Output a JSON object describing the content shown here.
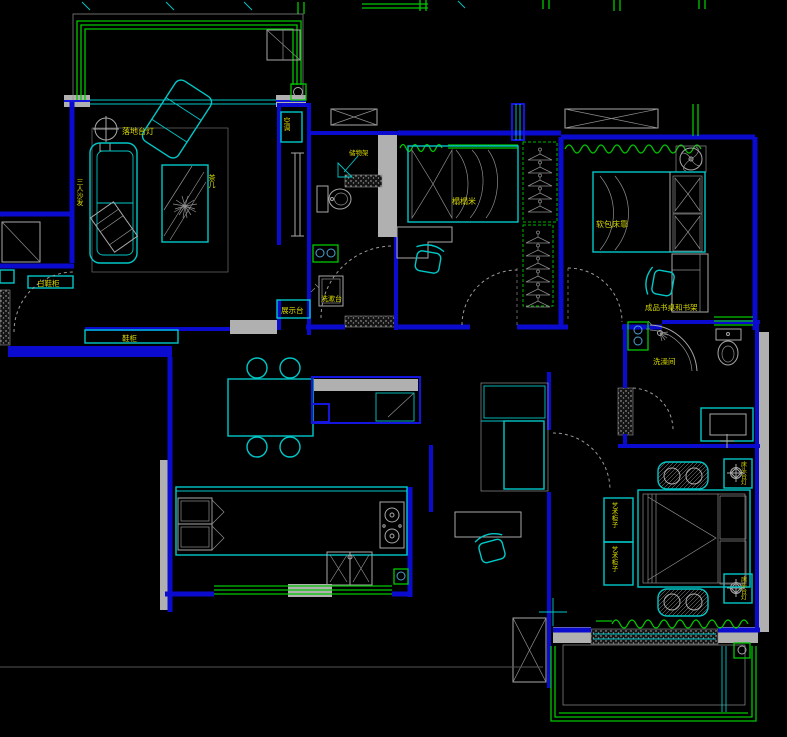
{
  "drawing": {
    "type": "apartment floor plan (CAD)",
    "colors": {
      "background": "#000000",
      "wall": "#0b0bd0",
      "furniture": "#00c8c8",
      "window": "#00c800",
      "detail_gray": "#a8a8a8",
      "label": "#d8d800"
    }
  },
  "labels": {
    "floor_lamp": {
      "text": "落地台灯"
    },
    "sofa": {
      "text": "三人沙发"
    },
    "coffee_table": {
      "text": "茶几"
    },
    "ac_unit": {
      "text": "空调"
    },
    "storage_rack": {
      "text": "储物架"
    },
    "tatami": {
      "text": "榻榻米"
    },
    "bed_headboard": {
      "text": "软包床靠"
    },
    "desk_bookshelf": {
      "text": "成品书桌和书架"
    },
    "shoe_cabinet_small": {
      "text": "白鞋柜"
    },
    "shoe_cabinet": {
      "text": "鞋柜"
    },
    "display_stand": {
      "text": "展示台"
    },
    "wash_counter": {
      "text": "洗漱台"
    },
    "shower_room": {
      "text": "洗澡间"
    },
    "art_cabinet_1": {
      "text": "艺术柜子"
    },
    "art_cabinet_2": {
      "text": "艺术柜子"
    },
    "bedside_lamp_1": {
      "text": "床头台灯"
    },
    "bedside_lamp_2": {
      "text": "床头台灯"
    }
  }
}
